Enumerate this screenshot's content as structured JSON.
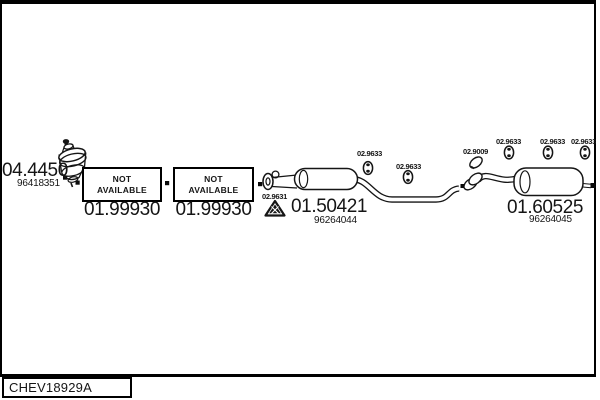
{
  "colors": {
    "ink": "#151515",
    "background": "#ffffff"
  },
  "plate": {
    "code": "CHEV18929A"
  },
  "catalyst": {
    "number": "04.4450",
    "oem": "96418351"
  },
  "boxes": [
    {
      "line1": "NOT",
      "line2": "AVAILABLE",
      "number": "01.99930"
    },
    {
      "line1": "NOT",
      "line2": "AVAILABLE",
      "number": "01.99930"
    }
  ],
  "gasket": {
    "number": "02.9631"
  },
  "centre_silencer": {
    "number": "01.50421",
    "oem": "96264044"
  },
  "rear_silencer": {
    "number": "01.60525",
    "oem": "96264045"
  },
  "clamp": {
    "number": "02.9009"
  },
  "hangers": [
    {
      "number": "02.9633"
    },
    {
      "number": "02.9633"
    },
    {
      "number": "02.9633"
    },
    {
      "number": "02.9633"
    },
    {
      "number": "02.9633"
    }
  ]
}
